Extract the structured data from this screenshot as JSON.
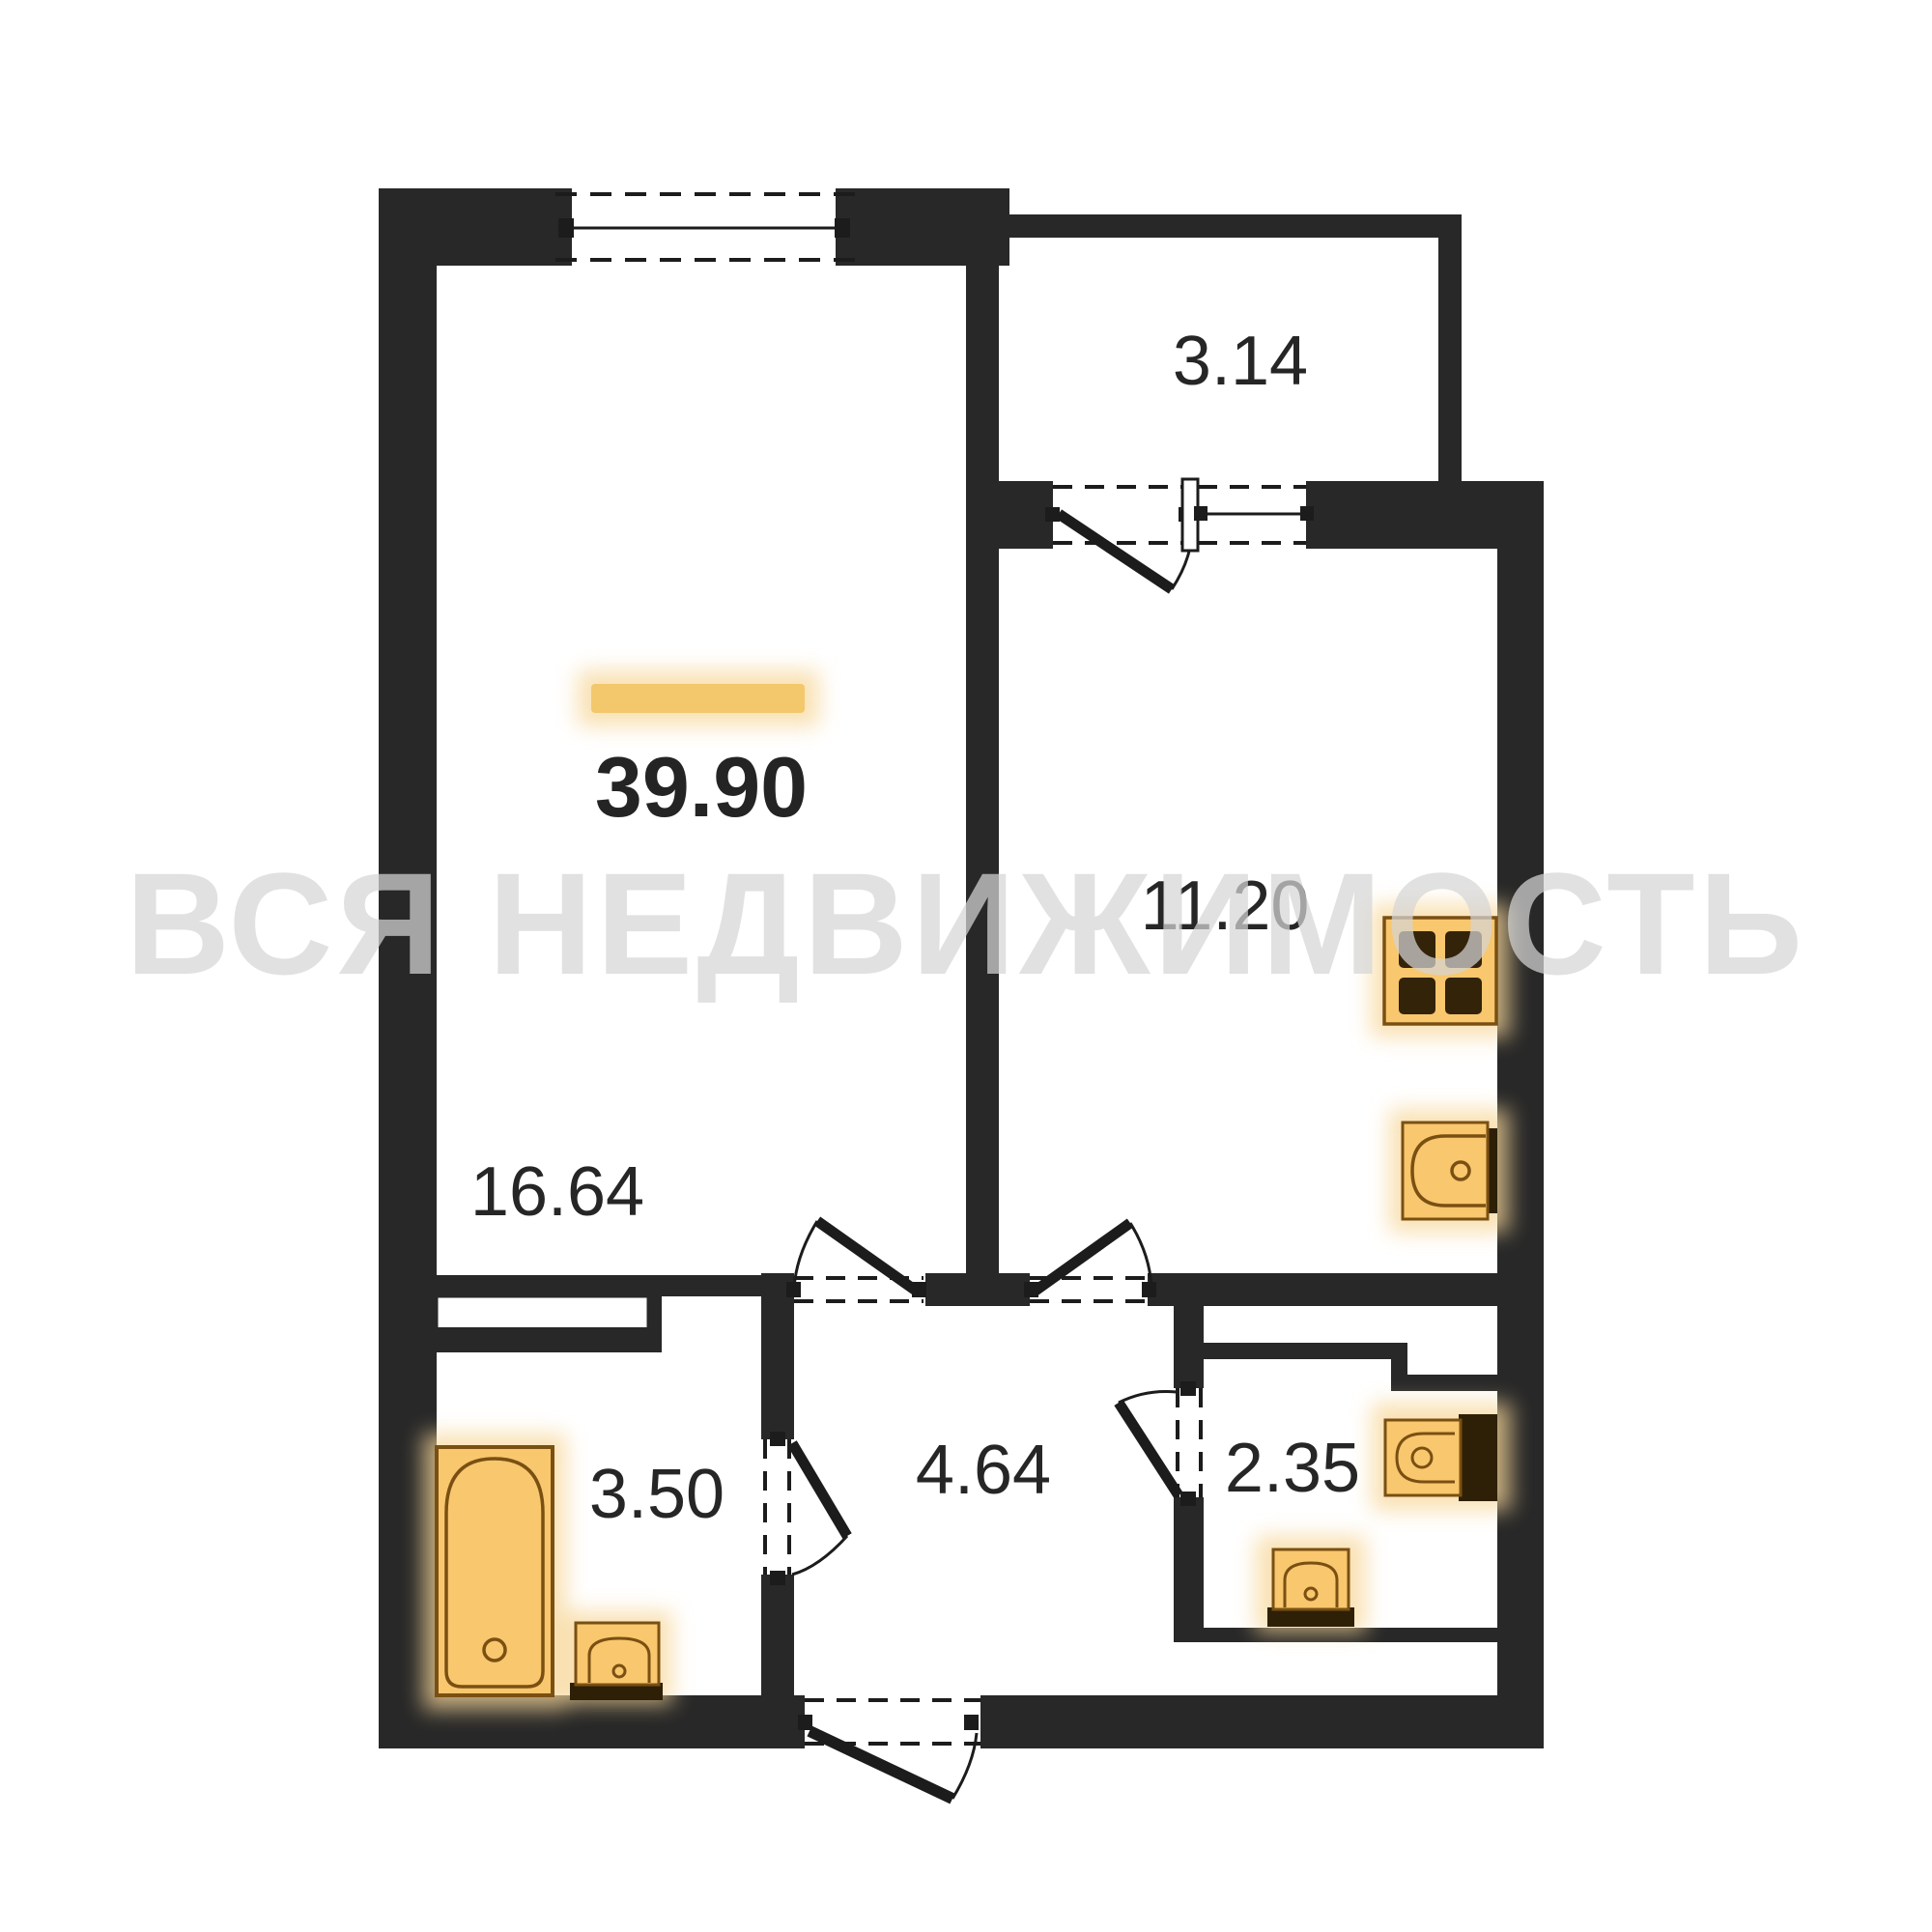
{
  "floorplan": {
    "total_area": "39.90",
    "watermark_text": "ВСЯ НЕДВИЖИМОСТЬ",
    "rooms": {
      "living_room": {
        "area": "16.64"
      },
      "kitchen": {
        "area": "11.20"
      },
      "balcony": {
        "area": "3.14"
      },
      "bathroom": {
        "area": "3.50"
      },
      "hallway": {
        "area": "4.64"
      },
      "wc": {
        "area": "2.35"
      }
    },
    "fixtures": [
      "bathtub-icon",
      "bathroom-sink-icon",
      "kitchen-stove-icon",
      "kitchen-sink-icon",
      "toilet-icon",
      "wc-sink-icon",
      "window-icon",
      "balcony-door-icon",
      "entrance-door-icon"
    ],
    "colors": {
      "wall": "#282828",
      "line": "#1c1c1c",
      "fixture_fill": "#f8c76e",
      "fixture_border": "#7a5012",
      "fixture_dark": "#2e2007",
      "accent_bar": "#f3c76b",
      "watermark": "#d6d6d6",
      "label_text": "#262626",
      "background": "#ffffff"
    }
  }
}
